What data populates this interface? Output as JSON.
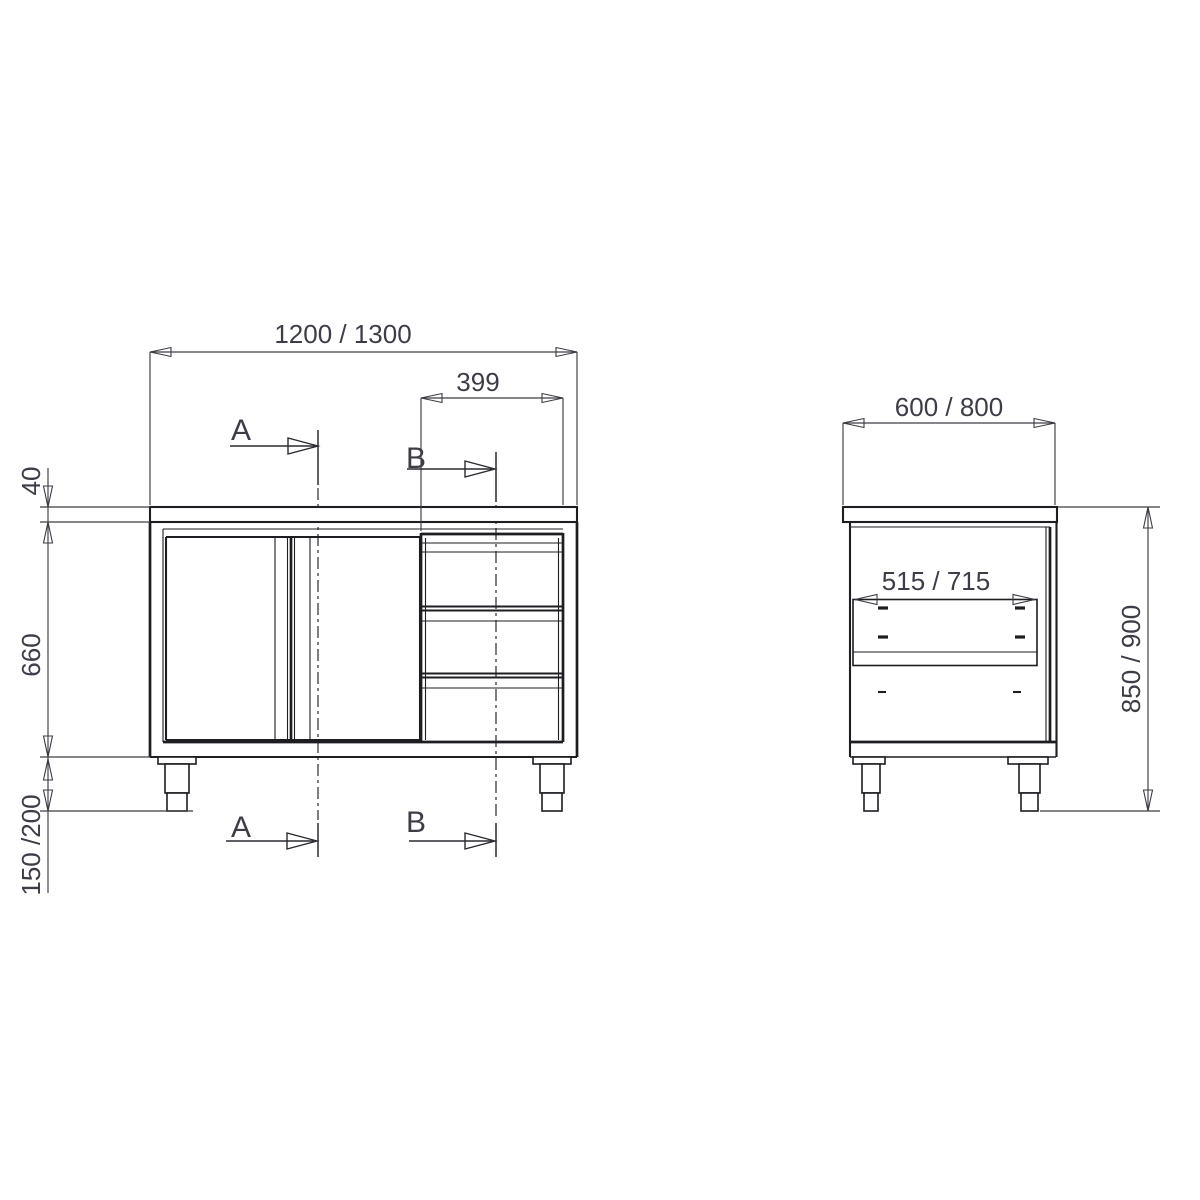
{
  "front_view": {
    "overall_width_label": "1200 / 1300",
    "drawer_unit_width_label": "399",
    "worktop_thickness_label": "40",
    "body_height_label": "660",
    "leg_height_label": "150 /200",
    "section_a_label": "A",
    "section_b_label": "B"
  },
  "side_view": {
    "depth_label": "600 / 800",
    "inner_width_label": "515 / 715",
    "overall_height_label": "850 / 900"
  },
  "colors": {
    "background": "#ffffff",
    "object_lines": "#1d1d22",
    "dimension_lines": "#3c3c44",
    "label_text": "#3d3d47"
  }
}
